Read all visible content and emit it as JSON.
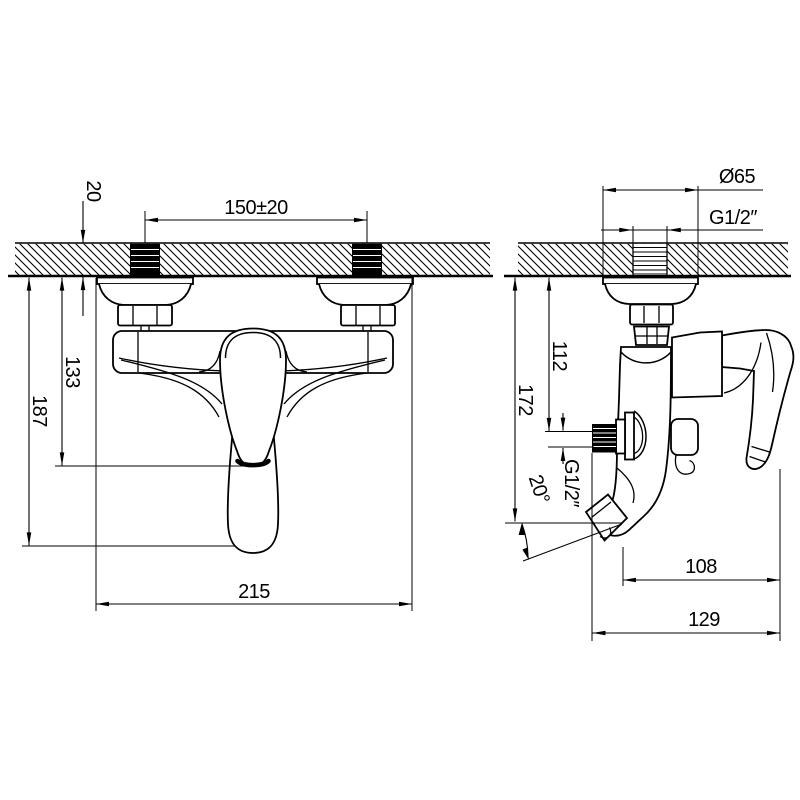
{
  "drawing": {
    "subject": "Wall-mounted bath shower mixer faucet — installation dimension drawing",
    "units": "mm",
    "line_color": "#000000",
    "background": "#ffffff",
    "views": {
      "front": {
        "label": "front view",
        "dims": {
          "wall_thickness": "20",
          "inlet_spacing": "150±20",
          "wall_to_handle": "133",
          "wall_to_lever_end": "187",
          "overall_width": "215"
        }
      },
      "side": {
        "label": "side view",
        "dims": {
          "flange_diameter": "Ø65",
          "inlet_thread": "G1/2″",
          "wall_to_outlet": "112",
          "wall_to_spout": "172",
          "outlet_thread": "G1/2″",
          "spout_angle": "20°",
          "spout_reach": "108",
          "overall_depth": "129"
        }
      }
    }
  }
}
